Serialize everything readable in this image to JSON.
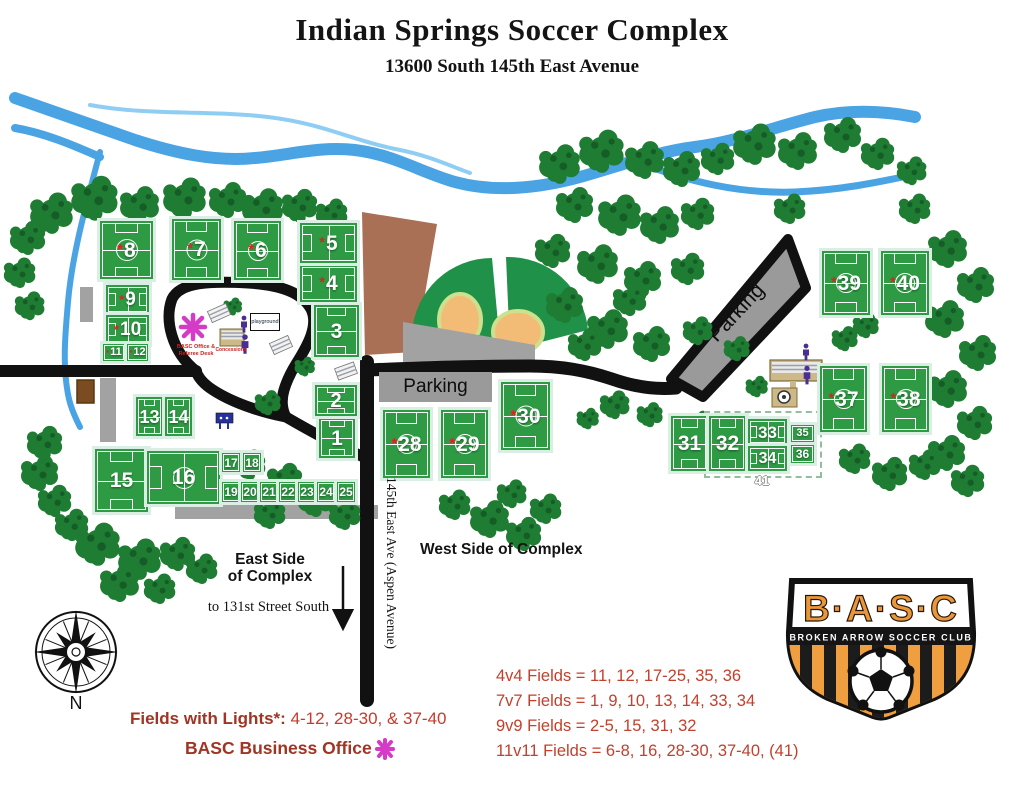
{
  "header": {
    "title": "Indian Springs Soccer Complex",
    "subtitle": "13600 South 145th East Avenue"
  },
  "map": {
    "parking_west_label": "Parking",
    "parking_northeast_label": "Parking",
    "playground_label": "playground",
    "office_label_line1": "BASC Office &",
    "office_label_line2": "Referee Desk",
    "concessions_label": "Concessions",
    "east_side_line1": "East Side",
    "east_side_line2": "of Complex",
    "west_side_label": "West Side of Complex",
    "to_131st_label": "to 131st Street South",
    "street_label": "145th East Ave (Aspen Avenue)",
    "compass_label": "N",
    "combined_field_label": "41",
    "lights_marker": "*",
    "icons": {
      "office_marker": "basc-office-asterisk-icon",
      "compass": "compass-rose-icon",
      "restrooms": "restroom-person-icon",
      "picnic_shelter": "picnic-shelter-icon",
      "concessions_building": "concessions-building-icon",
      "pavilion": "pavilion-icon",
      "south_arrow": "south-arrow-icon"
    },
    "fields": [
      {
        "n": 1,
        "lights": false,
        "x": 319,
        "y": 418,
        "w": 36,
        "h": 40,
        "o": "v",
        "s": "md"
      },
      {
        "n": 2,
        "lights": false,
        "x": 315,
        "y": 385,
        "w": 42,
        "h": 31,
        "o": "v",
        "s": "md"
      },
      {
        "n": 3,
        "lights": false,
        "x": 314,
        "y": 305,
        "w": 45,
        "h": 52,
        "o": "v",
        "s": "md"
      },
      {
        "n": 4,
        "lights": true,
        "x": 300,
        "y": 265,
        "w": 57,
        "h": 37,
        "o": "h",
        "s": "md"
      },
      {
        "n": 5,
        "lights": true,
        "x": 300,
        "y": 223,
        "w": 57,
        "h": 40,
        "o": "h",
        "s": "md"
      },
      {
        "n": 6,
        "lights": true,
        "x": 234,
        "y": 221,
        "w": 47,
        "h": 59,
        "o": "v",
        "s": "lg"
      },
      {
        "n": 7,
        "lights": true,
        "x": 172,
        "y": 219,
        "w": 49,
        "h": 61,
        "o": "v",
        "s": "lg"
      },
      {
        "n": 8,
        "lights": true,
        "x": 100,
        "y": 221,
        "w": 53,
        "h": 58,
        "o": "v",
        "s": "lg"
      },
      {
        "n": 9,
        "lights": true,
        "x": 106,
        "y": 285,
        "w": 43,
        "h": 29,
        "o": "h",
        "s": "md"
      },
      {
        "n": 10,
        "lights": true,
        "x": 106,
        "y": 315,
        "w": 43,
        "h": 29,
        "o": "h",
        "s": "md"
      },
      {
        "n": 11,
        "lights": true,
        "x": 103,
        "y": 344,
        "w": 22,
        "h": 17,
        "o": "h",
        "s": "sm"
      },
      {
        "n": 12,
        "lights": true,
        "x": 127,
        "y": 344,
        "w": 21,
        "h": 17,
        "o": "h",
        "s": "sm"
      },
      {
        "n": 13,
        "lights": false,
        "x": 136,
        "y": 397,
        "w": 27,
        "h": 39,
        "o": "v",
        "s": "md"
      },
      {
        "n": 14,
        "lights": false,
        "x": 165,
        "y": 397,
        "w": 27,
        "h": 39,
        "o": "v",
        "s": "md"
      },
      {
        "n": 15,
        "lights": false,
        "x": 95,
        "y": 449,
        "w": 53,
        "h": 63,
        "o": "v",
        "s": "md"
      },
      {
        "n": 16,
        "lights": false,
        "x": 147,
        "y": 451,
        "w": 73,
        "h": 53,
        "o": "h",
        "s": "lg"
      },
      {
        "n": 17,
        "lights": false,
        "x": 222,
        "y": 453,
        "w": 18,
        "h": 19,
        "o": "v",
        "s": "sm"
      },
      {
        "n": 18,
        "lights": false,
        "x": 243,
        "y": 453,
        "w": 18,
        "h": 19,
        "o": "v",
        "s": "sm"
      },
      {
        "n": 19,
        "lights": false,
        "x": 222,
        "y": 482,
        "w": 18,
        "h": 20,
        "o": "v",
        "s": "sm"
      },
      {
        "n": 20,
        "lights": false,
        "x": 241,
        "y": 482,
        "w": 18,
        "h": 20,
        "o": "v",
        "s": "sm"
      },
      {
        "n": 21,
        "lights": false,
        "x": 260,
        "y": 482,
        "w": 18,
        "h": 20,
        "o": "v",
        "s": "sm"
      },
      {
        "n": 22,
        "lights": false,
        "x": 279,
        "y": 482,
        "w": 18,
        "h": 20,
        "o": "v",
        "s": "sm"
      },
      {
        "n": 23,
        "lights": false,
        "x": 298,
        "y": 482,
        "w": 18,
        "h": 20,
        "o": "v",
        "s": "sm"
      },
      {
        "n": 24,
        "lights": false,
        "x": 317,
        "y": 482,
        "w": 18,
        "h": 20,
        "o": "v",
        "s": "sm"
      },
      {
        "n": 25,
        "lights": false,
        "x": 337,
        "y": 482,
        "w": 18,
        "h": 20,
        "o": "v",
        "s": "sm"
      },
      {
        "n": 28,
        "lights": true,
        "x": 383,
        "y": 410,
        "w": 47,
        "h": 68,
        "o": "v",
        "s": "lg"
      },
      {
        "n": 29,
        "lights": true,
        "x": 441,
        "y": 410,
        "w": 47,
        "h": 68,
        "o": "v",
        "s": "lg"
      },
      {
        "n": 30,
        "lights": true,
        "x": 501,
        "y": 382,
        "w": 49,
        "h": 68,
        "o": "v",
        "s": "lg"
      },
      {
        "n": 31,
        "lights": false,
        "x": 671,
        "y": 416,
        "w": 37,
        "h": 55,
        "o": "v",
        "s": "md"
      },
      {
        "n": 32,
        "lights": false,
        "x": 709,
        "y": 416,
        "w": 37,
        "h": 55,
        "o": "v",
        "s": "md"
      },
      {
        "n": 33,
        "lights": false,
        "x": 748,
        "y": 419,
        "w": 39,
        "h": 26,
        "o": "h",
        "s": "md"
      },
      {
        "n": 34,
        "lights": false,
        "x": 748,
        "y": 446,
        "w": 39,
        "h": 25,
        "o": "h",
        "s": "md"
      },
      {
        "n": 35,
        "lights": false,
        "x": 791,
        "y": 425,
        "w": 23,
        "h": 17,
        "o": "h",
        "s": "sm"
      },
      {
        "n": 36,
        "lights": false,
        "x": 791,
        "y": 445,
        "w": 23,
        "h": 18,
        "o": "h",
        "s": "sm"
      },
      {
        "n": 37,
        "lights": true,
        "x": 820,
        "y": 366,
        "w": 47,
        "h": 66,
        "o": "v",
        "s": "lg"
      },
      {
        "n": 38,
        "lights": true,
        "x": 882,
        "y": 366,
        "w": 47,
        "h": 66,
        "o": "v",
        "s": "lg"
      },
      {
        "n": 39,
        "lights": true,
        "x": 822,
        "y": 251,
        "w": 48,
        "h": 64,
        "o": "v",
        "s": "lg"
      },
      {
        "n": 40,
        "lights": true,
        "x": 881,
        "y": 251,
        "w": 48,
        "h": 64,
        "o": "v",
        "s": "lg"
      }
    ]
  },
  "legend": {
    "lights_title": "Fields with Lights*:",
    "lights_values": " 4-12, 28-30, & 37-40",
    "office_title": "BASC Business Office",
    "office_marker_icon": "basc-office-asterisk-icon",
    "field_types": [
      "4v4 Fields = 11, 12, 17-25, 35, 36",
      "7v7 Fields = 1, 9, 10, 13, 14, 33, 34",
      "9v9 Fields = 2-5, 15, 31, 32",
      "11v11 Fields = 6-8, 16, 28-30, 37-40, (41)"
    ]
  },
  "logo": {
    "initials": "B·A·S·C",
    "club_name": "BROKEN ARROW SOCCER CLUB"
  },
  "colors": {
    "field_green": "#2e9b44",
    "tree_green": "#1e7c33",
    "river_blue": "#4aa4e4",
    "road_black": "#111111",
    "parking_gray": "#9a9a9a",
    "legend_red": "#c2402c",
    "office_magenta": "#d63bc8",
    "logo_orange": "#ef9f3f",
    "dirt_brown": "#a97055"
  }
}
